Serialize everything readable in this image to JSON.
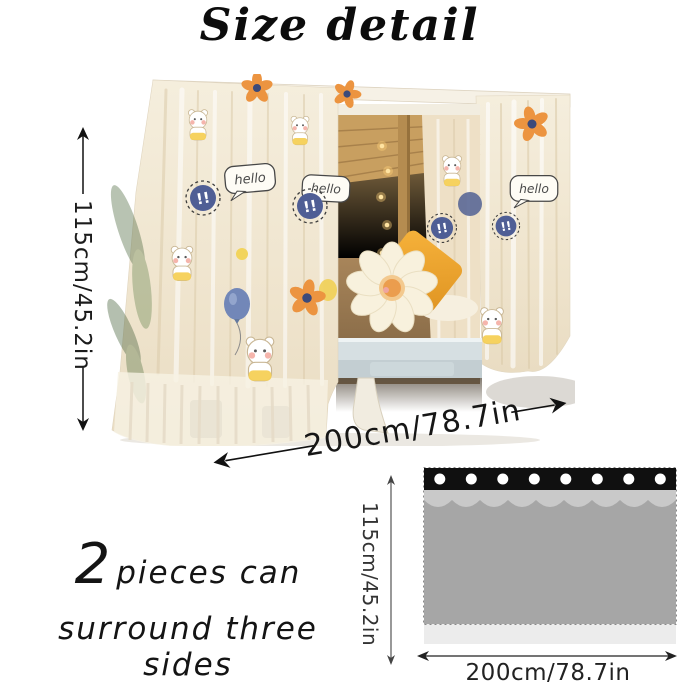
{
  "title": "Size detail",
  "photo": {
    "height_label": "115cm/45.2in",
    "width_label": "200cm/78.7in",
    "decor": {
      "hello": "hello",
      "exclaim": "!!"
    },
    "colors": {
      "curtain_cream": "#f2e9d8",
      "badge_navy": "#4f5e95",
      "pillow_yellow": "#f0a935",
      "wood": "#c89f60",
      "platform_gray": "#ccd7da"
    }
  },
  "caption": {
    "big": "2",
    "line1_rest": "pieces can",
    "line2": "surround three sides"
  },
  "schematic": {
    "height_label": "115cm/45.2in",
    "width_label": "200cm/78.7in",
    "grommet_count": 8,
    "fold_count": 5,
    "colors": {
      "band_black": "#101010",
      "grommet_white": "#ffffff",
      "valance_gray": "#c9c9c9",
      "body_gray": "#a6a6a6",
      "hem_light": "#ececec"
    }
  }
}
